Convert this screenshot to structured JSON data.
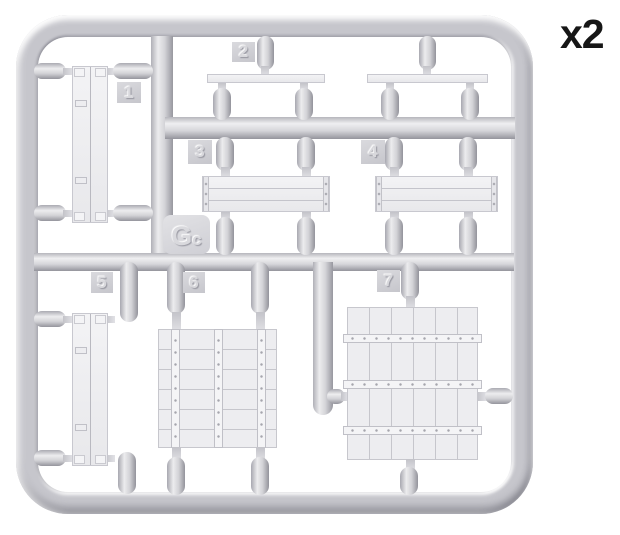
{
  "label": {
    "quantity": "x2"
  },
  "sprue": {
    "letter": "G",
    "letter_sub": "c"
  },
  "parts": [
    {
      "num": "1"
    },
    {
      "num": "2"
    },
    {
      "num": "3"
    },
    {
      "num": "4"
    },
    {
      "num": "5"
    },
    {
      "num": "6"
    },
    {
      "num": "7"
    }
  ],
  "colors": {
    "sprue_gray": "#c6c6cc",
    "part_gray": "#ededf0",
    "label_black": "#161616",
    "background": "#ffffff"
  }
}
